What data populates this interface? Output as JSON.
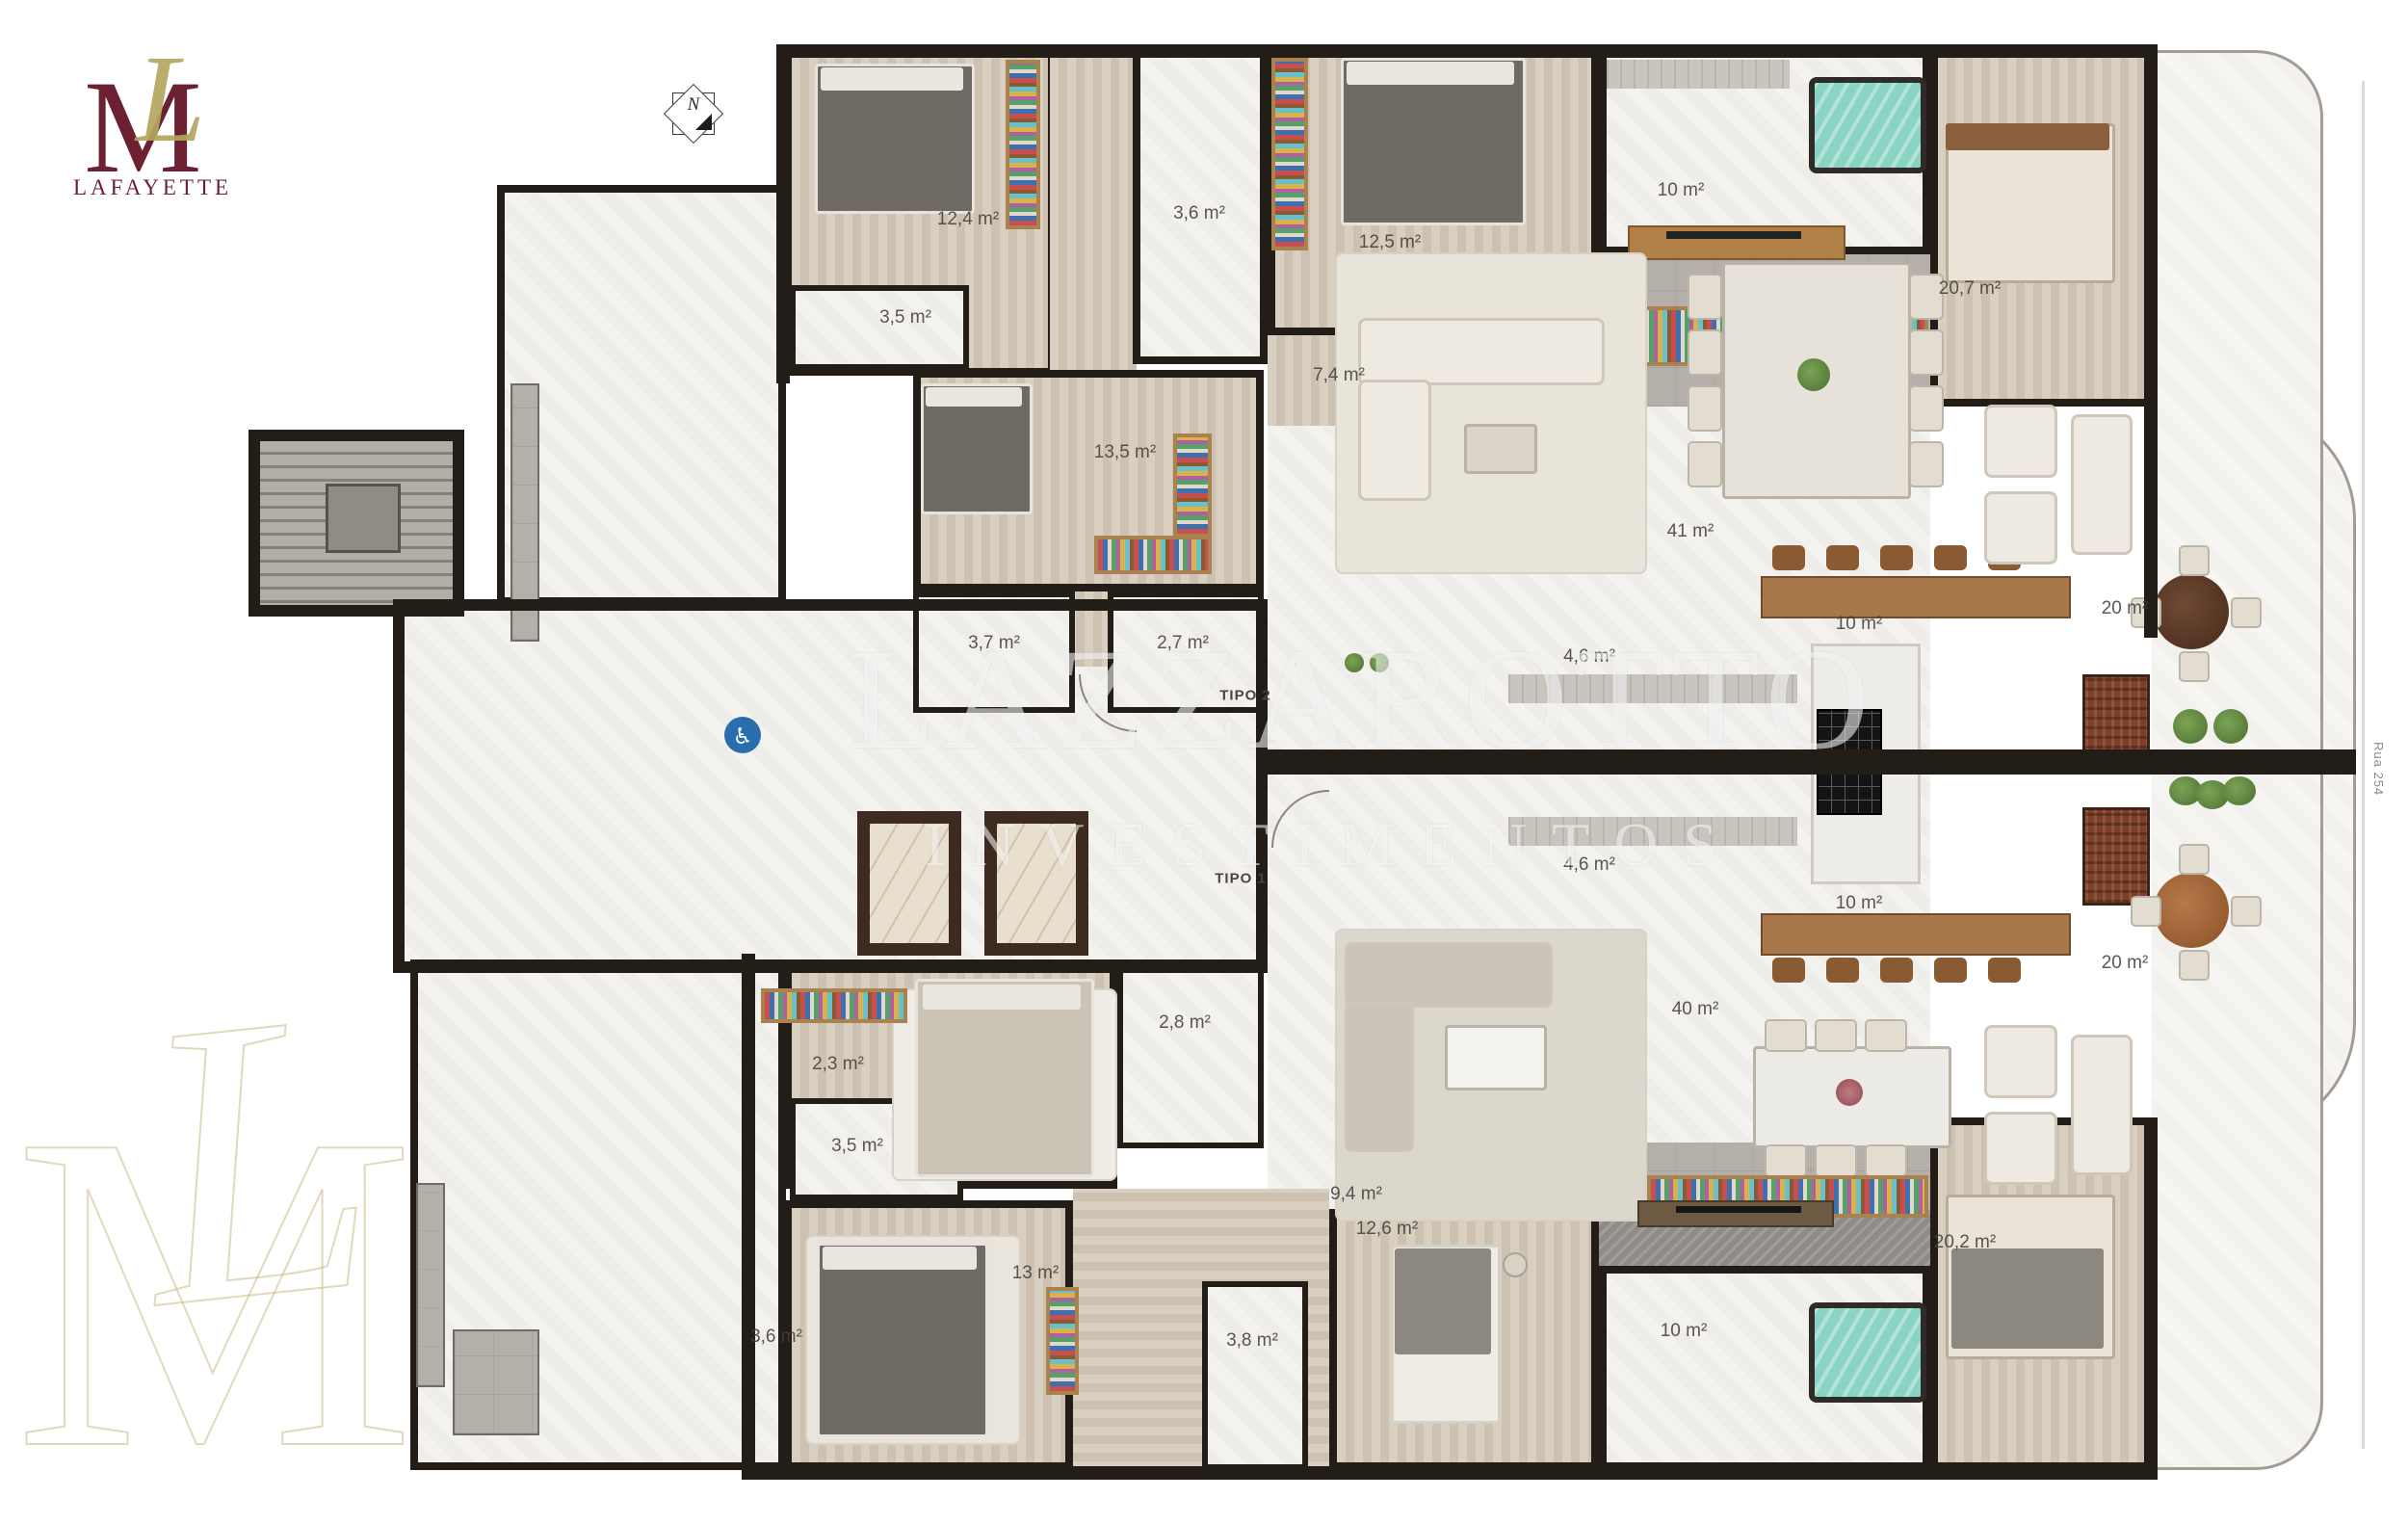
{
  "branding": {
    "name": "LAFAYETTE",
    "monogram_m": "M",
    "monogram_l": "L"
  },
  "compass": {
    "letter": "N"
  },
  "legend_tipo2": {
    "title": "TIPO 2",
    "line1": "4 suítes. 3 vagas",
    "line2": "185 m² privativos",
    "line3": "295 m² total"
  },
  "legend_tipo1": {
    "title": "TIPO 1",
    "line1": "4 suítes. 3 vagas",
    "line2": "185 m² privativos",
    "line3": "295 m² total"
  },
  "builder": {
    "name": "Dallo"
  },
  "street": {
    "label": "Rua 254"
  },
  "watermark": {
    "line1": "LAZZAROTTO",
    "line2": "INVESTIMENTOS"
  },
  "corner_monogram": {
    "letter_m": "M",
    "letter_l": "L"
  },
  "unit_tags": {
    "tipo2": "TIPO 2",
    "tipo1": "TIPO 1"
  },
  "rooms": {
    "t2_suite1": "12,4 m²",
    "t2_bath1": "3,5 m²",
    "t2_bath2": "3,6 m²",
    "t2_suite2": "12,5 m²",
    "t2_hall": "7,4 m²",
    "t2_master_bath": "10 m²",
    "t2_master": "20,7 m²",
    "t2_suite3": "13,5 m²",
    "t2_bath3": "3,7 m²",
    "t2_lavabo": "2,7 m²",
    "t2_living": "41 m²",
    "t2_terrace": "20 m²",
    "t2_kitchen_sm": "4,6 m²",
    "t2_kitchen": "10 m²",
    "t1_kitchen_sm": "4,6 m²",
    "t1_kitchen": "10 m²",
    "t1_terrace": "20 m²",
    "t1_living": "40 m²",
    "t1_bath28": "2,8 m²",
    "t1_closet23": "2,3 m²",
    "t1_bath35": "3,5 m²",
    "t1_hall94": "9,4 m²",
    "t1_suite13": "13 m²",
    "t1_bath36": "3,6 m²",
    "t1_bath38": "3,8 m²",
    "t1_suite126": "12,6 m²",
    "t1_master_bath": "10 m²",
    "t1_master": "20,2 m²"
  },
  "colors": {
    "wall": "#231d18",
    "wood_floor": "#d3c9ba",
    "marble_floor": "#f3f2ef",
    "gray_tile": "#b4afa8",
    "teal_tub": "#86d3c3",
    "logo_maroon": "#6b2132",
    "logo_gold": "#b2a75f",
    "dallo_gold": "#b3a343",
    "accessibility_blue": "#2a6fad",
    "plant_green": "#5f8a43"
  }
}
